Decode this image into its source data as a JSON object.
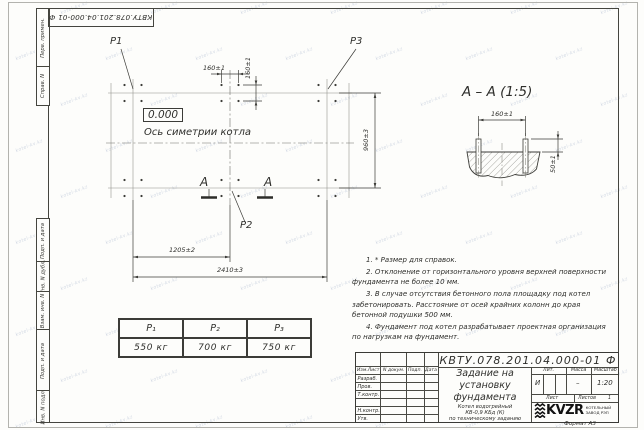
{
  "watermark": "kotel-kv.kz",
  "margin": {
    "perv_primen": "Перв. примен.",
    "sprav_n": "Справ. N",
    "podp_data_top": "Подп. и дата",
    "inv_n_dubl": "Инв. N дубл.",
    "vzam_inv_n": "Взам. инв. N",
    "podp_data_bottom": "Подп. и дата",
    "inv_n_podl": "Инв. N подл."
  },
  "plan": {
    "label_p1": "P1",
    "label_p2": "P2",
    "label_p3": "P3",
    "level_mark": "0.000",
    "symmetry_axis_label": "Ось симетрии котла",
    "dim_bolt_spacing_h": "160±1",
    "dim_bolt_spacing_v": "160±1",
    "dim_width": "960±3",
    "dim_mid_span": "1205±2",
    "dim_full_span": "2410±3",
    "section_mark": "А"
  },
  "section_view": {
    "title": "А – А (1:5)",
    "dim_bolt_spacing": "160±1",
    "dim_bolt_height": "50±1"
  },
  "notes": [
    "1. * Размер для справок.",
    "2. Отклонение от горизонтального уровня верхней поверхности фундамента не более 10 мм.",
    "3. В случае отсутствия бетонного пола площадку под котел забетонировать. Расстояние от осей крайних колонн до края бетонной подушки 500 мм.",
    "4. Фундамент под котел разрабатывает проектная организация по нагрузкам на фундамент."
  ],
  "load_table": {
    "headers": [
      "P₁",
      "P₂",
      "P₃"
    ],
    "values": [
      "550 кг",
      "700 кг",
      "750 кг"
    ]
  },
  "title_block": {
    "doc_number": "КВТУ.078.201.04.000-01 Ф",
    "header_cells": [
      "Изм.Лист",
      "N докум.",
      "Подп.",
      "Дата"
    ],
    "row_labels": [
      "Разраб.",
      "Пров.",
      "Т.контр.",
      "Н.контр.",
      "Утв."
    ],
    "title_lines": [
      "Задание на",
      "установку",
      "фундамента"
    ],
    "subtitle_lines": [
      "Котел водогрейный",
      "КВ-0,9 КБд (К)",
      "по техническому заданию"
    ],
    "lit_header": "Лит.",
    "mass_header": "Масса",
    "scale_header": "Масштаб",
    "lit_value": "И",
    "mass_value": "–",
    "scale_value": "1:20",
    "sheet_label": "Лист",
    "sheets_label": "Листов",
    "sheets_value": "1",
    "logo_text": "KVZR",
    "logo_sub_lines": [
      "КОТЕЛЬНЫЙ",
      "ЗАВОД РЭП"
    ],
    "format_label": "Формат А3"
  }
}
